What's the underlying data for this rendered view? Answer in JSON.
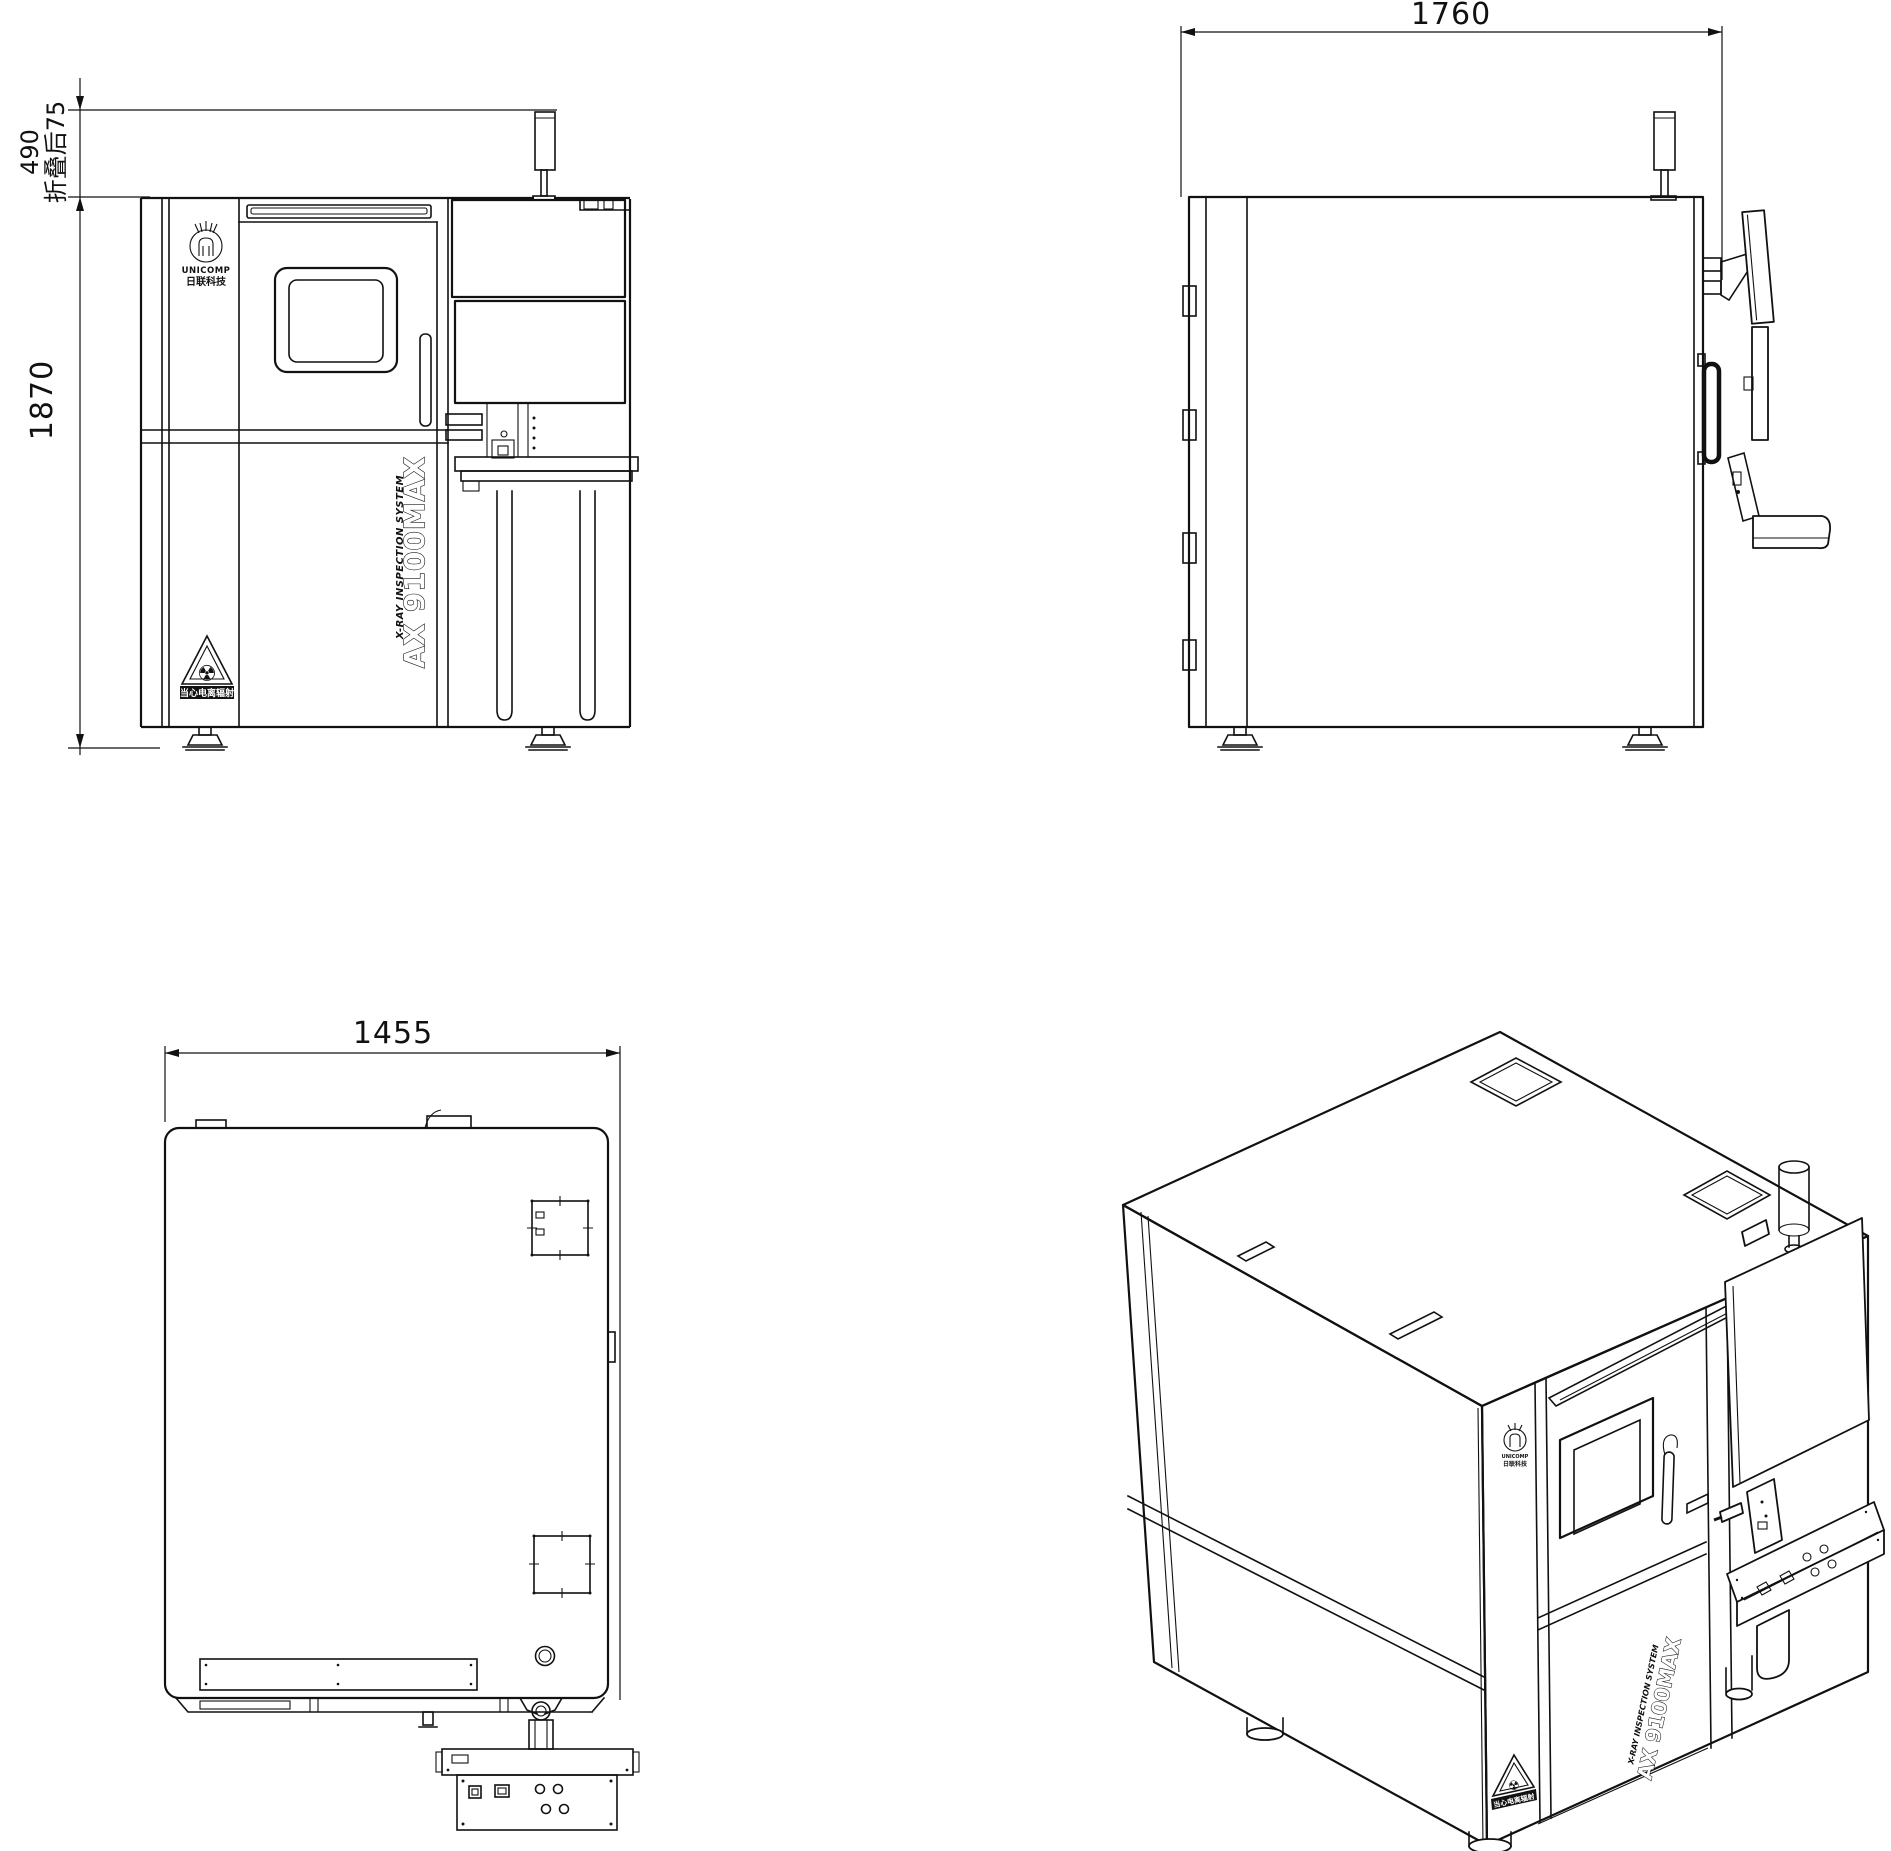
{
  "machine": {
    "model": "AX 9100MAX",
    "system": "X-RAY INSPECTION SYSTEM",
    "brand": "UNICOMP",
    "brand_cn": "日联科技",
    "radiation_warning": "当心电离辐射",
    "radiation_glyph": "☢"
  },
  "dims": {
    "front_tower": "490",
    "front_tower_folded": "折叠后75",
    "front_height": "1870",
    "side_depth": "1760",
    "top_width": "1455"
  }
}
